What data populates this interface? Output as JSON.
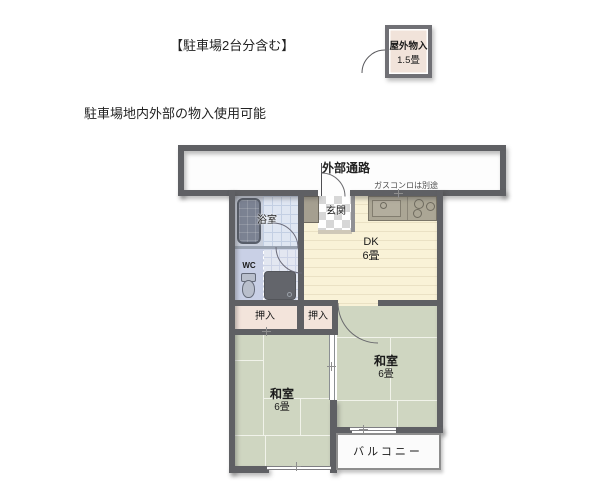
{
  "notes": {
    "parking": "【駐車場2台分含む】",
    "storage_usage": "駐車場地内外部の物入使用可能",
    "gas": "ガスコンロは別途"
  },
  "outdoor_storage": {
    "name": "屋外物入",
    "size": "1.5畳"
  },
  "rooms": {
    "passage": {
      "label": "外部通路"
    },
    "bathroom": {
      "label": "浴室"
    },
    "wc": {
      "label": "WC"
    },
    "entrance": {
      "label": "玄関"
    },
    "dk": {
      "label": "DK",
      "size": "6畳"
    },
    "closet_left": {
      "label": "押入"
    },
    "closet_right": {
      "label": "押入"
    },
    "washitsu_left": {
      "label": "和室",
      "size": "6畳"
    },
    "washitsu_right": {
      "label": "和室",
      "size": "6畳"
    },
    "balcony": {
      "label": "バルコニー"
    }
  },
  "colors": {
    "wall": "#5f6064",
    "tatami": "#cfd6c1",
    "dk_floor": "#f9f2d7",
    "closet": "#f3e4db",
    "bath_tile": "#dfe6f2",
    "wc_floor": "#c9d0e6",
    "counter": "#aba695",
    "storage_fill": "#f1e3da"
  }
}
